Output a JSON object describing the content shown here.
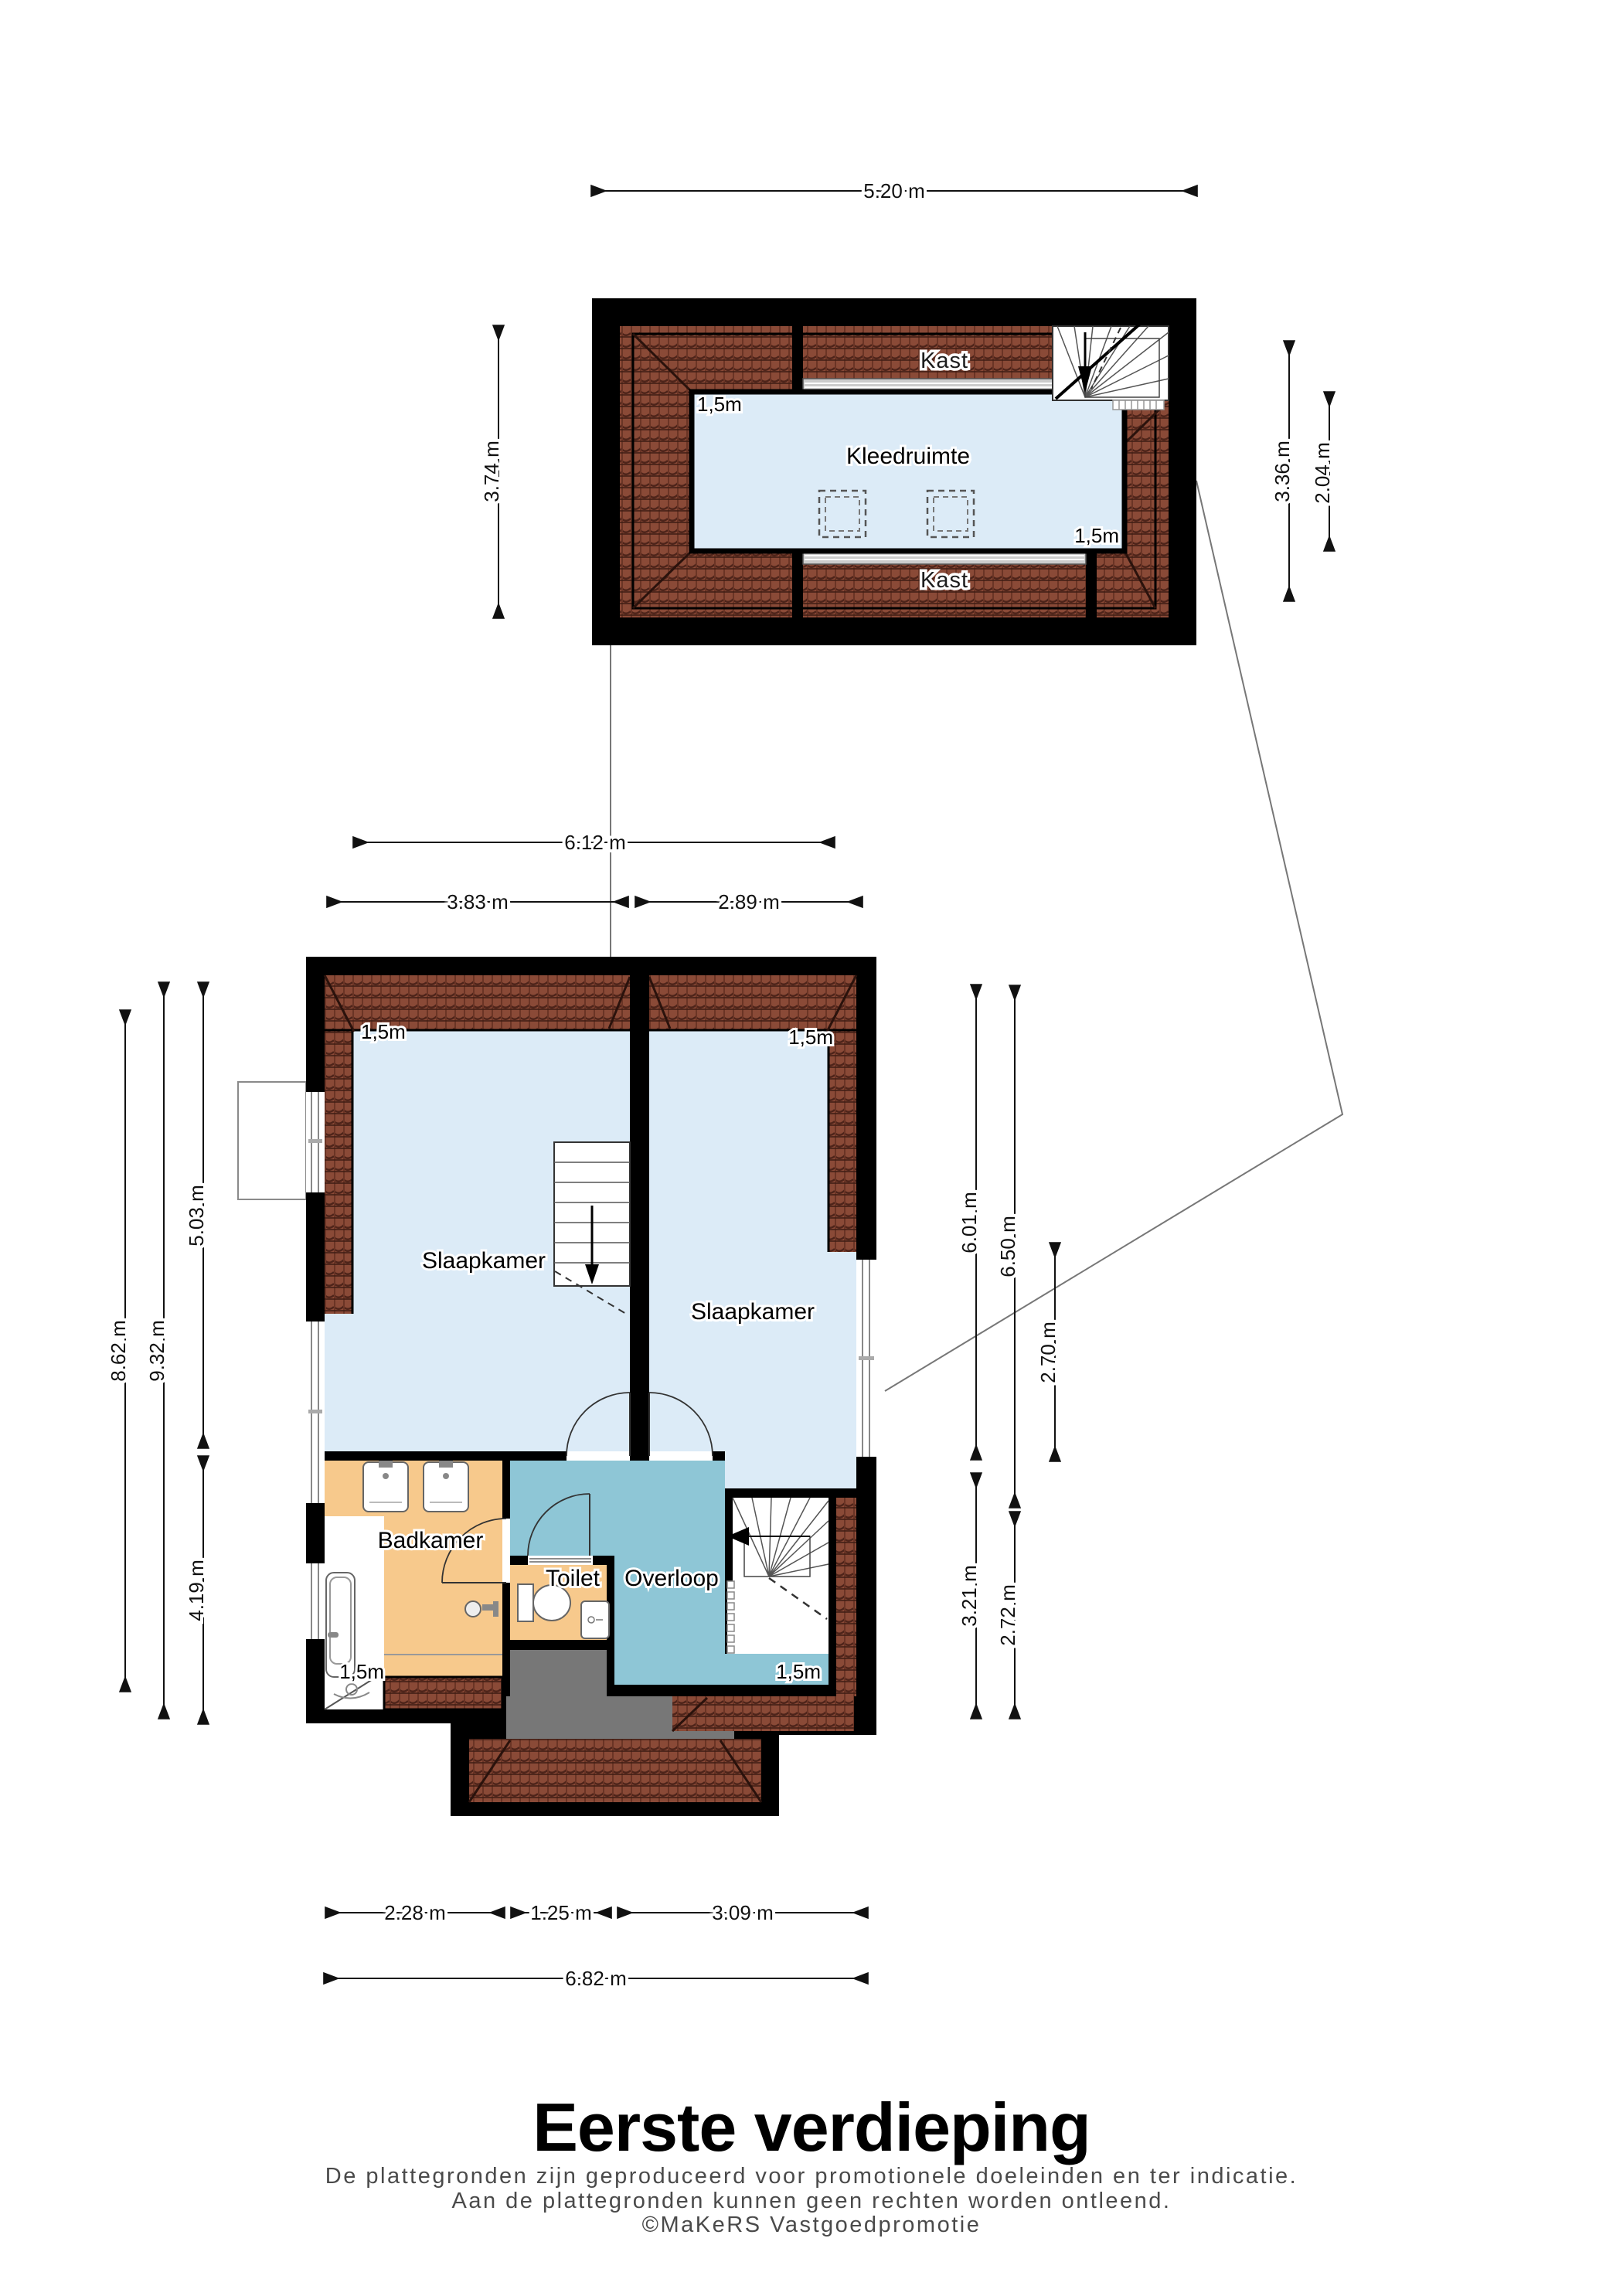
{
  "page": {
    "title": "Eerste verdieping",
    "disclaimer_line1": "De plattegronden zijn geproduceerd voor promotionele doeleinden en ter indicatie.",
    "disclaimer_line2": "Aan de plattegronden kunnen geen rechten worden ontleend.",
    "disclaimer_line3": "©MaKeRS Vastgoedpromotie"
  },
  "colors": {
    "wall": "#000000",
    "roof_tile": "#8a4a37",
    "roof_tile_dark": "#4e241a",
    "room_blue": "#dcebf7",
    "room_teal": "#8ec6d6",
    "room_orange": "#f7c98c",
    "dormer_gray": "#777777",
    "bench_gray": "#cccccc"
  },
  "attic": {
    "room_label": "Kleedruimte",
    "kast_top_label": "Kast",
    "kast_bottom_label": "Kast",
    "height_top_left": "1,5m",
    "height_bottom_right": "1,5m",
    "dims": {
      "width": "5.20 m",
      "left": "3.74 m",
      "right_outer": "3.36 m",
      "right_inner": "2.04 m"
    }
  },
  "first_floor": {
    "bedroom_left_label": "Slaapkamer",
    "bedroom_right_label": "Slaapkamer",
    "bathroom_label": "Badkamer",
    "toilet_label": "Toilet",
    "landing_label": "Overloop",
    "height_top_left": "1,5m",
    "height_top_right": "1,5m",
    "height_bathroom": "1,5m",
    "height_landing": "1,5m",
    "dims": {
      "top_total": "6.12 m",
      "top_left": "3.83 m",
      "top_right": "2.89 m",
      "left_outer": "8.62 m",
      "left_full": "9.32 m",
      "left_upper": "5.03 m",
      "left_lower": "4.19 m",
      "right_upper_a": "6.01 m",
      "right_upper_b": "6.50 m",
      "right_window": "2.70 m",
      "right_lower_a": "3.21 m",
      "right_lower_b": "2.72 m",
      "bottom_bathroom": "2.28 m",
      "bottom_toilet": "1.25 m",
      "bottom_landing": "3.09 m",
      "bottom_total": "6.82 m"
    }
  }
}
